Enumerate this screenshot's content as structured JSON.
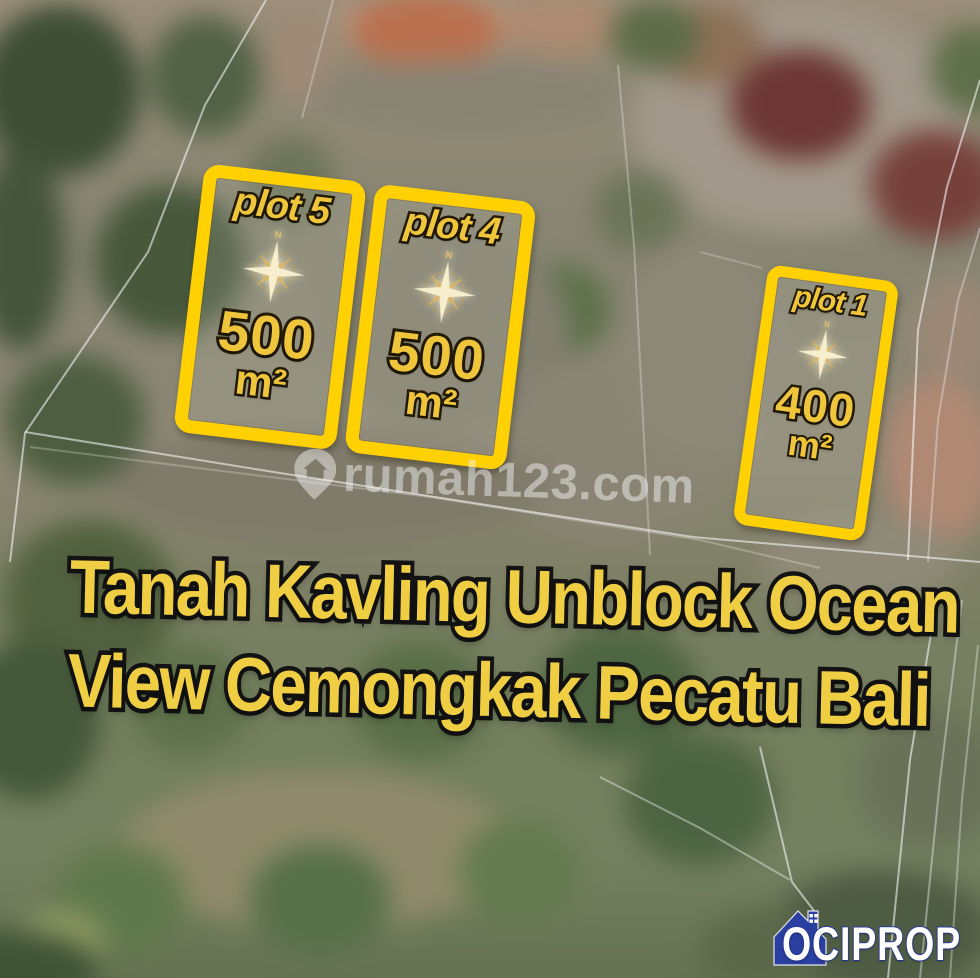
{
  "title": {
    "line1": "Tanah Kavling Unblock Ocean",
    "line2": "View Cemongkak Pecatu Bali"
  },
  "plots": [
    {
      "label": "plot 5",
      "area": "500",
      "unit": "m²"
    },
    {
      "label": "plot 4",
      "area": "500",
      "unit": "m²"
    },
    {
      "label": "plot 1",
      "area": "400",
      "unit": "m²"
    }
  ],
  "compass": {
    "north_label": "N"
  },
  "watermark": {
    "site": "rumah123.com"
  },
  "logo": {
    "brand": "OCIPROP"
  },
  "colors": {
    "plot_outline": "#FFD103",
    "plot_text": "#EFC53C",
    "title_text": "#F0CE44",
    "logo_blue": "#2B3FA0"
  }
}
